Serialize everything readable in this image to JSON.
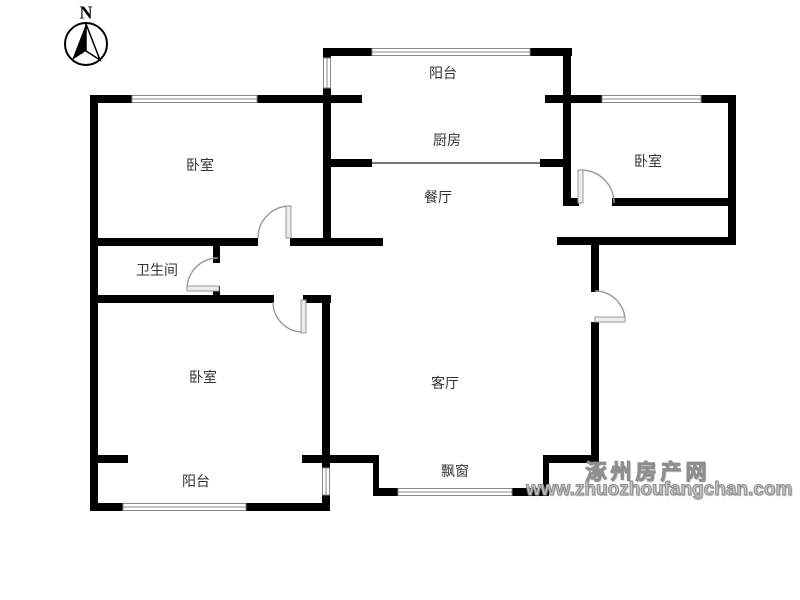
{
  "compass": {
    "label": "N"
  },
  "rooms": {
    "balcony_top": {
      "label": "阳台"
    },
    "kitchen": {
      "label": "厨房"
    },
    "bedroom_top_left": {
      "label": "卧室"
    },
    "bedroom_top_right": {
      "label": "卧室"
    },
    "dining": {
      "label": "餐厅"
    },
    "bathroom": {
      "label": "卫生间"
    },
    "bedroom_bottom_left": {
      "label": "卧室"
    },
    "living": {
      "label": "客厅"
    },
    "bay_window": {
      "label": "飘窗"
    },
    "balcony_bottom": {
      "label": "阳台"
    }
  },
  "watermark": {
    "site_name": "涿州房产网",
    "url": "www.zhuozhoufangchan.com"
  },
  "colors": {
    "wall": "#000000",
    "background": "#ffffff",
    "label_text": "#333333",
    "watermark_gray": "#8e8e8e",
    "door_arc": "#9a9a9a",
    "window_line": "#888888"
  }
}
